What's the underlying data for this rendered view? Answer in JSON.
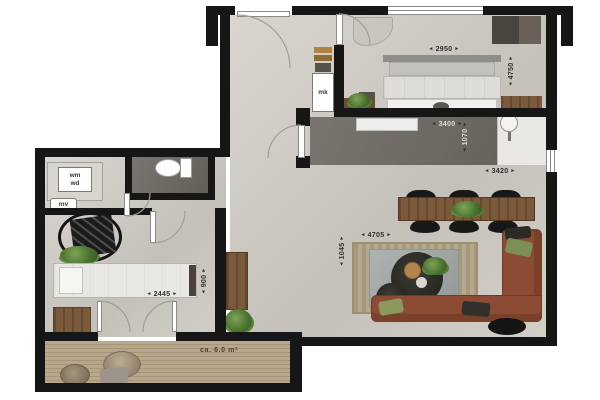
{
  "labels": {
    "meter_cupboard": "mk",
    "washer": "wm",
    "dryer": "wd",
    "ventilation": "mv",
    "balcony_area": "ca. 6.0 m²"
  },
  "dimensions": {
    "master_bedroom_width": "2950",
    "master_bedroom_depth": "4750",
    "kitchen_width": "3400",
    "kitchen_depth": "1070",
    "dining_width": "3420",
    "living_width": "4705",
    "living_depth": "1045",
    "bed_length": "2445",
    "bed_width": "900"
  },
  "colors": {
    "wall": "#161616",
    "concrete_floor": "#ccc8c1",
    "wet_room_floor": "#6e6963",
    "wood": "#7b5a3c",
    "sofa": "#8c4c34",
    "deck": "#b7a78d",
    "plant": "#47702e"
  }
}
